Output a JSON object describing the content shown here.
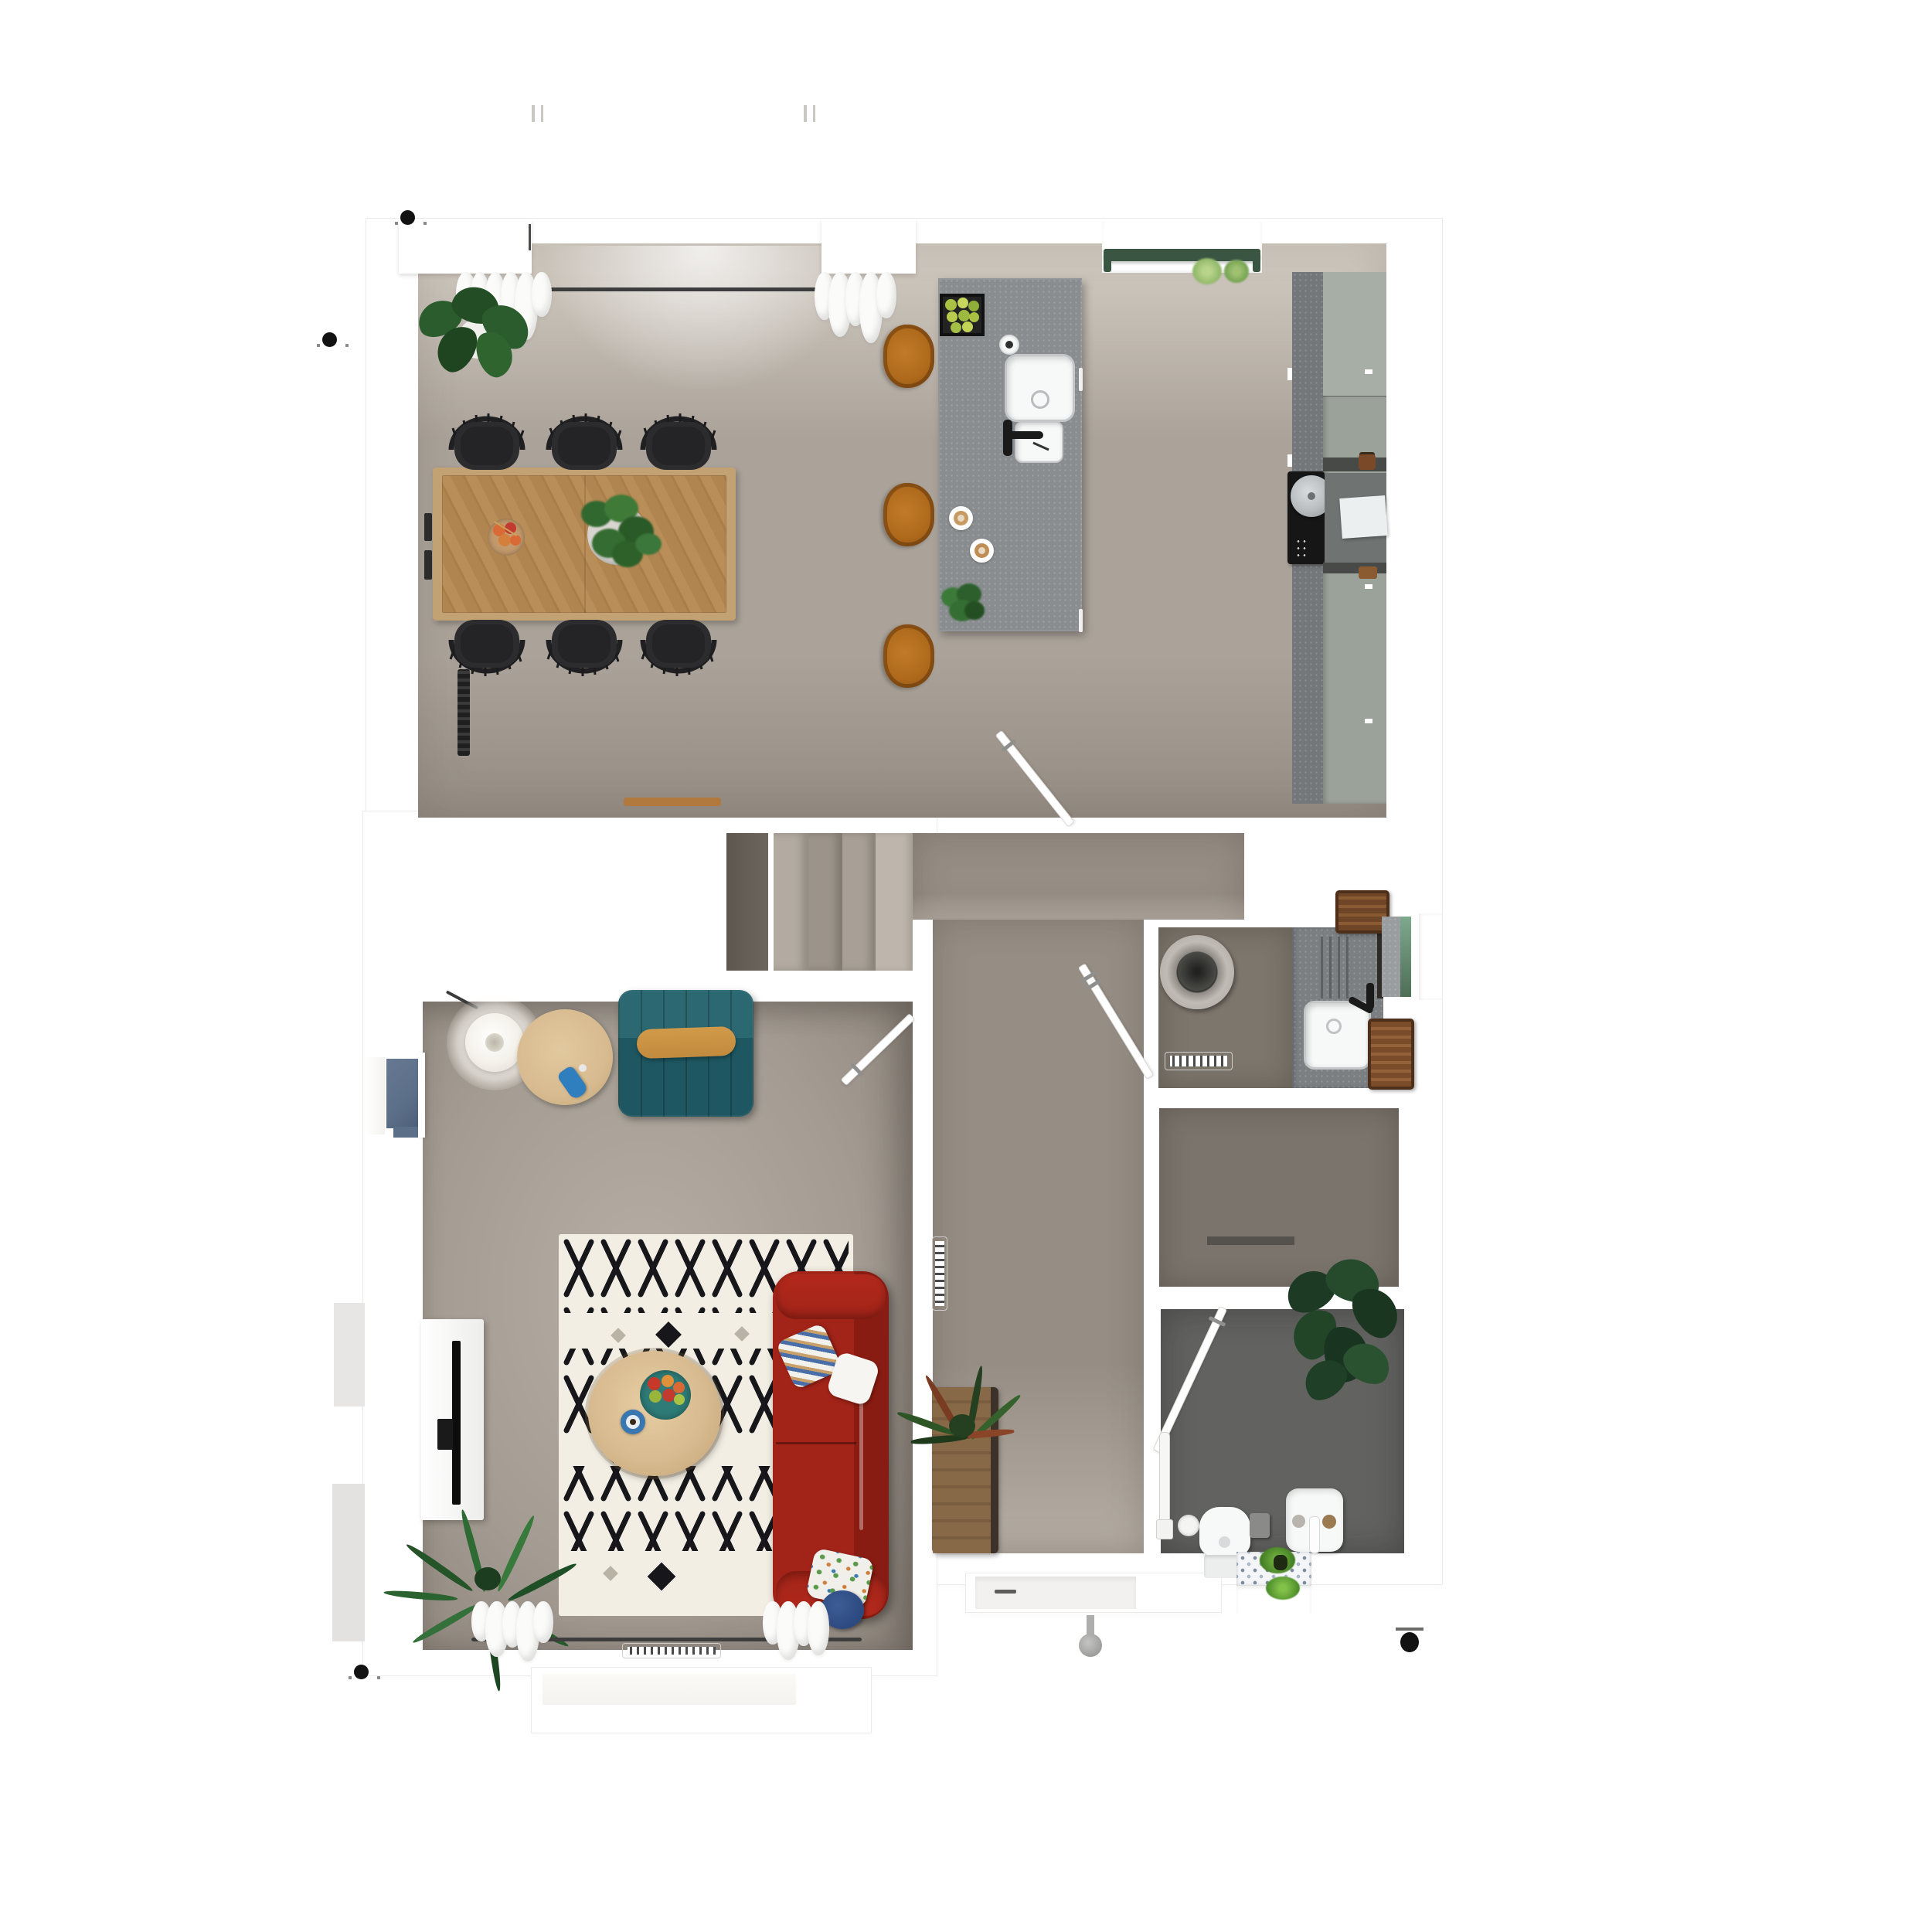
{
  "scene": {
    "kind": "architectural-floor-plan-render",
    "view": "top-down orthographic",
    "content": "ground floor of a house with open kitchen-dining room, stair hall, living room, utility room, shower room, bathroom and entry porch"
  },
  "colors": {
    "white": "#ffffff",
    "wall-shadow": "#ecebe9",
    "kitchen-floor-light": "#d3ccc3",
    "kitchen-floor": "#aba39a",
    "kitchen-floor-dark": "#948c83",
    "hall-floor": "#968e85",
    "hall-floor-light": "#b3aba1",
    "living-floor": "#a49c93",
    "living-floor-light": "#b6aea5",
    "utility-floor": "#7d766d",
    "shower-floor": "#7b746c",
    "bath-floor": "#626260",
    "porch-floor": "#f2f1ef",
    "stair-under": "#6b655e",
    "stair-1": "#b3aba1",
    "stair-2": "#9c948a",
    "stair-3": "#a8a096",
    "stair-4": "#beb6ac",
    "island-top": "#8a8d90",
    "worktop": "#74777a",
    "cabinet-sage": "#9ba29a",
    "cabinet-sage-light": "#a7aea6",
    "backsplash-dark": "#474a47",
    "cooktop-black": "#161616",
    "table-wood": "#d4b88f",
    "table-wood-edge": "#c2a172",
    "chair-black": "#2c2c2e",
    "stool-amber": "#b06a1c",
    "sofa-teal": "#2b6872",
    "sofa-teal-seat": "#1e5761",
    "bolster-gold": "#c18a3d",
    "sofa-red": "#a22318",
    "sofa-red-dark": "#891c12",
    "rug-base": "#f2eee4",
    "rug-pattern": "#17171b",
    "coffee-table-wood": "#d8bb90",
    "bench-wood": "#876847",
    "plant-green": "#2b5c2d",
    "plant-dark": "#1d3a24",
    "palm-green": "#2e6a33",
    "herb-green": "#8fb768",
    "blue-radiator": "#5c6f88",
    "curtain-white": "#fbfbfa",
    "rail-dark": "#3d3d3d",
    "green-window-bar": "#3a5542",
    "window-glass-green": "#7da98c",
    "fruit-orange": "#d96a35",
    "fruit-red": "#c23b2e",
    "lime-green": "#a9c243",
    "marker-black": "#121212",
    "metal-gray": "#8f8f8d",
    "brown-basket": "#6f4527",
    "tan-mat": "#b2793f",
    "blue-bottle": "#2f7fbe",
    "teal-bowl": "#2e7b77",
    "blue-cup": "#3a77b0",
    "navy-pillow": "#2c4a80",
    "tv-black": "#0d0d0d",
    "sink-white": "#f7f8f8",
    "faucet-black": "#1a1a1a"
  },
  "rooms": [
    {
      "name": "kitchen-dining",
      "floor": "kitchen-floor",
      "features": [
        "dining table",
        "6 spindle chairs",
        "kitchen island",
        "3 bar stools",
        "tall cabinet run",
        "induction hob",
        "double sink",
        "north windows with curtains",
        "herb window planter"
      ]
    },
    {
      "name": "stair-hall",
      "floor": "hall-floor",
      "features": [
        "staircase",
        "4 visible treads"
      ]
    },
    {
      "name": "hallway",
      "floor": "hall-floor",
      "features": [
        "wooden bench with fern",
        "vertical radiator",
        "front door porch"
      ]
    },
    {
      "name": "living-room",
      "floor": "living-floor",
      "features": [
        "red 3-seat sofa",
        "teal channel sofa",
        "berber rug",
        "round coffee tables",
        "floor lamp",
        "tv console",
        "palm plant",
        "south window with curtains",
        "west window with blue radiator"
      ]
    },
    {
      "name": "utility-room",
      "floor": "utility-floor",
      "features": [
        "laundry basket",
        "counter with sink",
        "black faucet",
        "wicker baskets",
        "radiator",
        "east window"
      ]
    },
    {
      "name": "shower-room",
      "floor": "shower-floor",
      "features": [
        "threshold strip"
      ]
    },
    {
      "name": "bathroom",
      "floor": "bath-floor",
      "features": [
        "toilet",
        "washbasin",
        "monstera plant",
        "towel rail",
        "patterned tile planter"
      ]
    }
  ],
  "exterior": {
    "markers": [
      "north wall marker",
      "west wall marker",
      "southwest marker",
      "southeast knob",
      "porch knob",
      "roof tick marks"
    ]
  }
}
